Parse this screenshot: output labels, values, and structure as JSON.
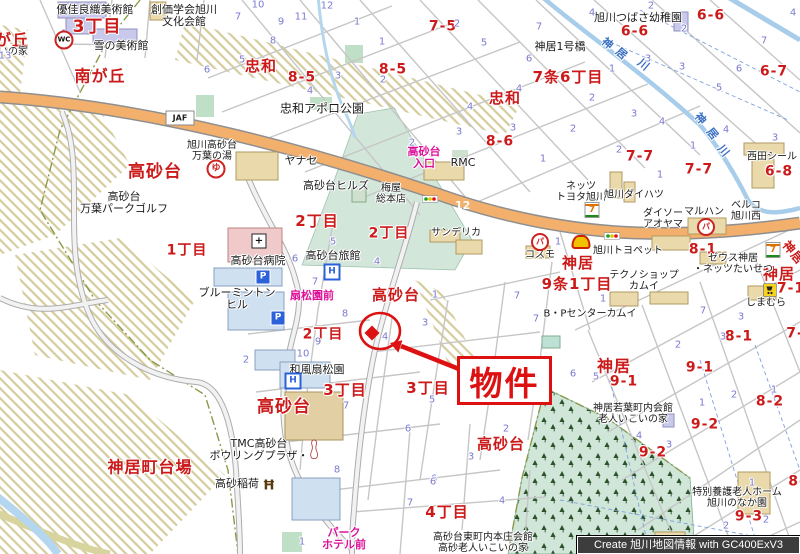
{
  "credit": "Create 旭川地図情報 with GC400ExV3",
  "marker": {
    "label": "物件"
  },
  "colors": {
    "district_red": "#cc1a1a",
    "lot_number_blue": "#7a7ad0",
    "busstop_pink": "#dd1199",
    "water_blue": "#3a6fc4",
    "road_orange": "#f3b06c",
    "route_shield_blue": "#1d3ecc",
    "forest_green": "#cfe6d8",
    "marker_red": "#dd1111"
  },
  "districts_red": [
    {
      "t": "が丘",
      "x": 12,
      "y": 40,
      "s": 16
    },
    {
      "t": "3丁目",
      "x": 97,
      "y": 27,
      "s": 17
    },
    {
      "t": "南が丘",
      "x": 100,
      "y": 76,
      "s": 16
    },
    {
      "t": "忠和",
      "x": 261,
      "y": 66,
      "s": 15
    },
    {
      "t": "8-5",
      "x": 302,
      "y": 78,
      "s": 14
    },
    {
      "t": "8-5",
      "x": 393,
      "y": 70,
      "s": 14
    },
    {
      "t": "7-5",
      "x": 443,
      "y": 27,
      "s": 14
    },
    {
      "t": "忠和",
      "x": 505,
      "y": 98,
      "s": 15
    },
    {
      "t": "7条6丁目",
      "x": 568,
      "y": 77,
      "s": 15
    },
    {
      "t": "6-6",
      "x": 711,
      "y": 16,
      "s": 14
    },
    {
      "t": "6-6",
      "x": 635,
      "y": 32,
      "s": 14
    },
    {
      "t": "6-7",
      "x": 774,
      "y": 72,
      "s": 14
    },
    {
      "t": "8-6",
      "x": 500,
      "y": 142,
      "s": 14
    },
    {
      "t": "高砂台",
      "x": 155,
      "y": 172,
      "s": 17
    },
    {
      "t": "7-7",
      "x": 640,
      "y": 157,
      "s": 14
    },
    {
      "t": "7-7",
      "x": 699,
      "y": 170,
      "s": 14
    },
    {
      "t": "6-8",
      "x": 779,
      "y": 172,
      "s": 14
    },
    {
      "t": "神居",
      "x": 578,
      "y": 263,
      "s": 15
    },
    {
      "t": "9条1丁目",
      "x": 577,
      "y": 284,
      "s": 15
    },
    {
      "t": "8-1",
      "x": 703,
      "y": 250,
      "s": 14
    },
    {
      "t": "神居",
      "x": 779,
      "y": 274,
      "s": 15
    },
    {
      "t": "7-1",
      "x": 791,
      "y": 289,
      "s": 14
    },
    {
      "t": "神居",
      "x": 793,
      "y": 253,
      "s": 12,
      "r": 50
    },
    {
      "t": "2丁目",
      "x": 317,
      "y": 221,
      "s": 15
    },
    {
      "t": "2丁目",
      "x": 389,
      "y": 234,
      "s": 14
    },
    {
      "t": "1丁目",
      "x": 187,
      "y": 251,
      "s": 14
    },
    {
      "t": "高砂台",
      "x": 396,
      "y": 295,
      "s": 15
    },
    {
      "t": "2丁目",
      "x": 323,
      "y": 335,
      "s": 14
    },
    {
      "t": "8-1",
      "x": 739,
      "y": 337,
      "s": 14
    },
    {
      "t": "7-",
      "x": 795,
      "y": 334,
      "s": 14
    },
    {
      "t": "高砂台",
      "x": 284,
      "y": 407,
      "s": 17
    },
    {
      "t": "3丁目",
      "x": 345,
      "y": 390,
      "s": 15
    },
    {
      "t": "3丁目",
      "x": 428,
      "y": 388,
      "s": 15
    },
    {
      "t": "高砂台",
      "x": 501,
      "y": 444,
      "s": 15
    },
    {
      "t": "神居町台場",
      "x": 150,
      "y": 467,
      "s": 16
    },
    {
      "t": "神居",
      "x": 614,
      "y": 366,
      "s": 16
    },
    {
      "t": "9-1",
      "x": 624,
      "y": 382,
      "s": 14
    },
    {
      "t": "9-1",
      "x": 700,
      "y": 368,
      "s": 14
    },
    {
      "t": "8-2",
      "x": 770,
      "y": 402,
      "s": 14
    },
    {
      "t": "9-2",
      "x": 705,
      "y": 425,
      "s": 14
    },
    {
      "t": "9-2",
      "x": 653,
      "y": 453,
      "s": 14
    },
    {
      "t": "4丁目",
      "x": 447,
      "y": 512,
      "s": 15
    },
    {
      "t": "9-3",
      "x": 749,
      "y": 517,
      "s": 14
    },
    {
      "t": "8-",
      "x": 797,
      "y": 482,
      "s": 14
    }
  ],
  "places_black": [
    {
      "t": "優佳良織美術館",
      "x": 95,
      "y": 10,
      "s": 11
    },
    {
      "t": "雪の美術館",
      "x": 121,
      "y": 46,
      "s": 11
    },
    {
      "t": "創価学会旭川\n文化会館",
      "x": 184,
      "y": 16,
      "s": 11
    },
    {
      "t": "いの家",
      "x": 13,
      "y": 53,
      "s": 10
    },
    {
      "t": "忠和アポロ公園",
      "x": 322,
      "y": 109,
      "s": 12
    },
    {
      "t": "ヤナセ",
      "x": 301,
      "y": 161,
      "s": 11
    },
    {
      "t": "高砂台ヒルズ",
      "x": 336,
      "y": 186,
      "s": 11
    },
    {
      "t": "梅屋\n総本店",
      "x": 391,
      "y": 195,
      "s": 10
    },
    {
      "t": "旭川高砂台\n万葉の湯",
      "x": 212,
      "y": 152,
      "s": 10
    },
    {
      "t": "高砂台\n万葉パークゴルフ",
      "x": 124,
      "y": 203,
      "s": 11
    },
    {
      "t": "RMC",
      "x": 463,
      "y": 163,
      "s": 11
    },
    {
      "t": "ネッツ\nトヨタ旭川",
      "x": 581,
      "y": 193,
      "s": 10
    },
    {
      "t": "西田シール",
      "x": 772,
      "y": 158,
      "s": 10
    },
    {
      "t": "旭川ダイハツ",
      "x": 634,
      "y": 196,
      "s": 10
    },
    {
      "t": "ダイソー\nアオヤマ",
      "x": 663,
      "y": 220,
      "s": 10
    },
    {
      "t": "マルハン",
      "x": 704,
      "y": 213,
      "s": 10
    },
    {
      "t": "ベルコ\n旭川西",
      "x": 746,
      "y": 212,
      "s": 10
    },
    {
      "t": "旭川トヨペット",
      "x": 628,
      "y": 252,
      "s": 10
    },
    {
      "t": "ゼウス神居\n・ネッツたいせつ",
      "x": 733,
      "y": 265,
      "s": 10
    },
    {
      "t": "テクノショップ\nカムイ",
      "x": 644,
      "y": 282,
      "s": 10
    },
    {
      "t": "B・Pセンターカムイ",
      "x": 590,
      "y": 315,
      "s": 10
    },
    {
      "t": "しまむら",
      "x": 766,
      "y": 304,
      "s": 10
    },
    {
      "t": "サンデリカ",
      "x": 456,
      "y": 234,
      "s": 10
    },
    {
      "t": "コスモ",
      "x": 540,
      "y": 256,
      "s": 10
    },
    {
      "t": "神居1号橋",
      "x": 560,
      "y": 47,
      "s": 11
    },
    {
      "t": "旭川つばさ幼稚園",
      "x": 638,
      "y": 18,
      "s": 11
    },
    {
      "t": "和風扇松園",
      "x": 317,
      "y": 370,
      "s": 11
    },
    {
      "t": "TMC高砂台\nボウリングプラザ・",
      "x": 259,
      "y": 450,
      "s": 11
    },
    {
      "t": "高砂稲荷",
      "x": 237,
      "y": 484,
      "s": 11
    },
    {
      "t": "神居若葉町内会館\n老人いこいの家",
      "x": 633,
      "y": 415,
      "s": 10
    },
    {
      "t": "高砂台東町内本庄会館\n高砂老人いこいの家",
      "x": 483,
      "y": 544,
      "s": 10
    },
    {
      "t": "特別養護老人ホーム\n旭川のなか園",
      "x": 737,
      "y": 499,
      "s": 10
    },
    {
      "t": "高砂台病院",
      "x": 258,
      "y": 261,
      "s": 11
    },
    {
      "t": "高砂台旅館",
      "x": 333,
      "y": 256,
      "s": 11
    },
    {
      "t": "ブルーミントン\nヒル",
      "x": 237,
      "y": 299,
      "s": 11
    }
  ],
  "busstops_pink": [
    {
      "t": "高砂台\n入口",
      "x": 424,
      "y": 158,
      "s": 11
    },
    {
      "t": "扇松園前",
      "x": 312,
      "y": 296,
      "s": 11
    },
    {
      "t": "パーク\nホテル前",
      "x": 344,
      "y": 539,
      "s": 11
    }
  ],
  "river_labels": [
    {
      "t": "神",
      "x": 607,
      "y": 44,
      "r": 40
    },
    {
      "t": "居",
      "x": 621,
      "y": 54,
      "r": 40
    },
    {
      "t": "川",
      "x": 643,
      "y": 65,
      "r": 40
    },
    {
      "t": "神",
      "x": 700,
      "y": 119,
      "r": 50
    },
    {
      "t": "居",
      "x": 712,
      "y": 134,
      "r": 50
    },
    {
      "t": "川",
      "x": 723,
      "y": 151,
      "r": 50
    }
  ],
  "lot_numbers_blue": [
    {
      "t": "1",
      "x": 64,
      "y": 35
    },
    {
      "t": "13",
      "x": 5,
      "y": 57
    },
    {
      "t": "7",
      "x": 238,
      "y": 18
    },
    {
      "t": "10",
      "x": 258,
      "y": 6
    },
    {
      "t": "9",
      "x": 281,
      "y": 23
    },
    {
      "t": "11",
      "x": 301,
      "y": 18
    },
    {
      "t": "12",
      "x": 327,
      "y": 7
    },
    {
      "t": "8",
      "x": 273,
      "y": 42
    },
    {
      "t": "5",
      "x": 242,
      "y": 61
    },
    {
      "t": "6",
      "x": 207,
      "y": 71
    },
    {
      "t": "1",
      "x": 357,
      "y": 23
    },
    {
      "t": "1",
      "x": 382,
      "y": 43
    },
    {
      "t": "3",
      "x": 338,
      "y": 77
    },
    {
      "t": "2",
      "x": 383,
      "y": 81
    },
    {
      "t": "4",
      "x": 310,
      "y": 92
    },
    {
      "t": "2",
      "x": 457,
      "y": 25
    },
    {
      "t": "5",
      "x": 484,
      "y": 44
    },
    {
      "t": "7",
      "x": 539,
      "y": 28
    },
    {
      "t": "4",
      "x": 592,
      "y": 14
    },
    {
      "t": "6",
      "x": 529,
      "y": 60
    },
    {
      "t": "4",
      "x": 519,
      "y": 90
    },
    {
      "t": "2",
      "x": 592,
      "y": 99
    },
    {
      "t": "4",
      "x": 470,
      "y": 108
    },
    {
      "t": "2",
      "x": 651,
      "y": 7
    },
    {
      "t": "2",
      "x": 684,
      "y": 30
    },
    {
      "t": "1",
      "x": 612,
      "y": 70
    },
    {
      "t": "3",
      "x": 648,
      "y": 60
    },
    {
      "t": "3",
      "x": 682,
      "y": 68
    },
    {
      "t": "6",
      "x": 739,
      "y": 70
    },
    {
      "t": "7",
      "x": 764,
      "y": 42
    },
    {
      "t": "5",
      "x": 719,
      "y": 89
    },
    {
      "t": "4",
      "x": 793,
      "y": 14
    },
    {
      "t": "3",
      "x": 459,
      "y": 133
    },
    {
      "t": "3",
      "x": 513,
      "y": 129
    },
    {
      "t": "1",
      "x": 543,
      "y": 160
    },
    {
      "t": "2",
      "x": 573,
      "y": 130
    },
    {
      "t": "2",
      "x": 412,
      "y": 144
    },
    {
      "t": "3",
      "x": 634,
      "y": 115
    },
    {
      "t": "4",
      "x": 662,
      "y": 123
    },
    {
      "t": "4",
      "x": 726,
      "y": 131
    },
    {
      "t": "3",
      "x": 775,
      "y": 139
    },
    {
      "t": "2",
      "x": 619,
      "y": 151
    },
    {
      "t": "1",
      "x": 693,
      "y": 147
    },
    {
      "t": "1",
      "x": 660,
      "y": 176
    },
    {
      "t": "5",
      "x": 333,
      "y": 243
    },
    {
      "t": "6",
      "x": 295,
      "y": 260
    },
    {
      "t": "7",
      "x": 315,
      "y": 283
    },
    {
      "t": "8",
      "x": 345,
      "y": 315
    },
    {
      "t": "9",
      "x": 318,
      "y": 343
    },
    {
      "t": "10",
      "x": 303,
      "y": 355
    },
    {
      "t": "4",
      "x": 377,
      "y": 263
    },
    {
      "t": "4",
      "x": 385,
      "y": 338
    },
    {
      "t": "1",
      "x": 435,
      "y": 296
    },
    {
      "t": "3",
      "x": 425,
      "y": 324
    },
    {
      "t": "7",
      "x": 517,
      "y": 297
    },
    {
      "t": "7",
      "x": 536,
      "y": 320
    },
    {
      "t": "1",
      "x": 558,
      "y": 243
    },
    {
      "t": "1",
      "x": 603,
      "y": 300
    },
    {
      "t": "7",
      "x": 703,
      "y": 312
    },
    {
      "t": "3",
      "x": 741,
      "y": 318
    },
    {
      "t": "2",
      "x": 678,
      "y": 346
    },
    {
      "t": "3",
      "x": 723,
      "y": 338
    },
    {
      "t": "7",
      "x": 346,
      "y": 407
    },
    {
      "t": "8",
      "x": 337,
      "y": 471
    },
    {
      "t": "2",
      "x": 246,
      "y": 361
    },
    {
      "t": "5",
      "x": 432,
      "y": 401
    },
    {
      "t": "6",
      "x": 408,
      "y": 430
    },
    {
      "t": "1",
      "x": 530,
      "y": 402
    },
    {
      "t": "2",
      "x": 506,
      "y": 430
    },
    {
      "t": "3",
      "x": 471,
      "y": 458
    },
    {
      "t": "6",
      "x": 434,
      "y": 480
    },
    {
      "t": "6",
      "x": 573,
      "y": 375
    },
    {
      "t": "5",
      "x": 596,
      "y": 378
    },
    {
      "t": "1",
      "x": 702,
      "y": 404
    },
    {
      "t": "2",
      "x": 734,
      "y": 396
    },
    {
      "t": "1",
      "x": 774,
      "y": 391
    },
    {
      "t": "4",
      "x": 639,
      "y": 437
    },
    {
      "t": "3",
      "x": 669,
      "y": 446
    },
    {
      "t": "6",
      "x": 433,
      "y": 483
    },
    {
      "t": "7",
      "x": 410,
      "y": 504
    },
    {
      "t": "4",
      "x": 502,
      "y": 502
    },
    {
      "t": "1",
      "x": 302,
      "y": 543
    },
    {
      "t": "1",
      "x": 752,
      "y": 484
    },
    {
      "t": "2",
      "x": 726,
      "y": 527
    },
    {
      "t": "2",
      "x": 766,
      "y": 521
    }
  ],
  "icons": [
    {
      "type": "wc",
      "x": 64,
      "y": 40,
      "t": "WC"
    },
    {
      "type": "yu",
      "x": 216,
      "y": 169,
      "t": "ゆ"
    },
    {
      "type": "route12",
      "x": 243,
      "y": 109,
      "t": "12"
    },
    {
      "type": "route12",
      "x": 455,
      "y": 198,
      "t": "12"
    },
    {
      "type": "busstop",
      "x": 370,
      "y": 170
    },
    {
      "type": "busstop",
      "x": 413,
      "y": 173
    },
    {
      "type": "busstop",
      "x": 295,
      "y": 281
    },
    {
      "type": "busstop",
      "x": 287,
      "y": 293
    },
    {
      "type": "busstop",
      "x": 350,
      "y": 550
    },
    {
      "type": "signal",
      "x": 430,
      "y": 197
    },
    {
      "type": "signal",
      "x": 612,
      "y": 234
    },
    {
      "type": "hospital",
      "x": 259,
      "y": 241,
      "t": "+"
    },
    {
      "type": "hotelH",
      "x": 332,
      "y": 272,
      "t": "H"
    },
    {
      "type": "hotelH",
      "x": 293,
      "y": 381,
      "t": "H"
    },
    {
      "type": "parking",
      "x": 263,
      "y": 277,
      "t": "P"
    },
    {
      "type": "parking",
      "x": 278,
      "y": 318,
      "t": "P"
    },
    {
      "type": "seven",
      "x": 592,
      "y": 210,
      "t": "7"
    },
    {
      "type": "seven",
      "x": 773,
      "y": 250,
      "t": "7"
    },
    {
      "type": "shell",
      "x": 581,
      "y": 242
    },
    {
      "type": "pa",
      "x": 540,
      "y": 242,
      "t": "パ"
    },
    {
      "type": "pa",
      "x": 706,
      "y": 227,
      "t": "パ"
    },
    {
      "type": "torii",
      "x": 269,
      "y": 484,
      "t": "Ħ"
    },
    {
      "type": "cart",
      "x": 770,
      "y": 291
    },
    {
      "type": "jaf",
      "x": 180,
      "y": 118,
      "t": "JAF"
    }
  ]
}
